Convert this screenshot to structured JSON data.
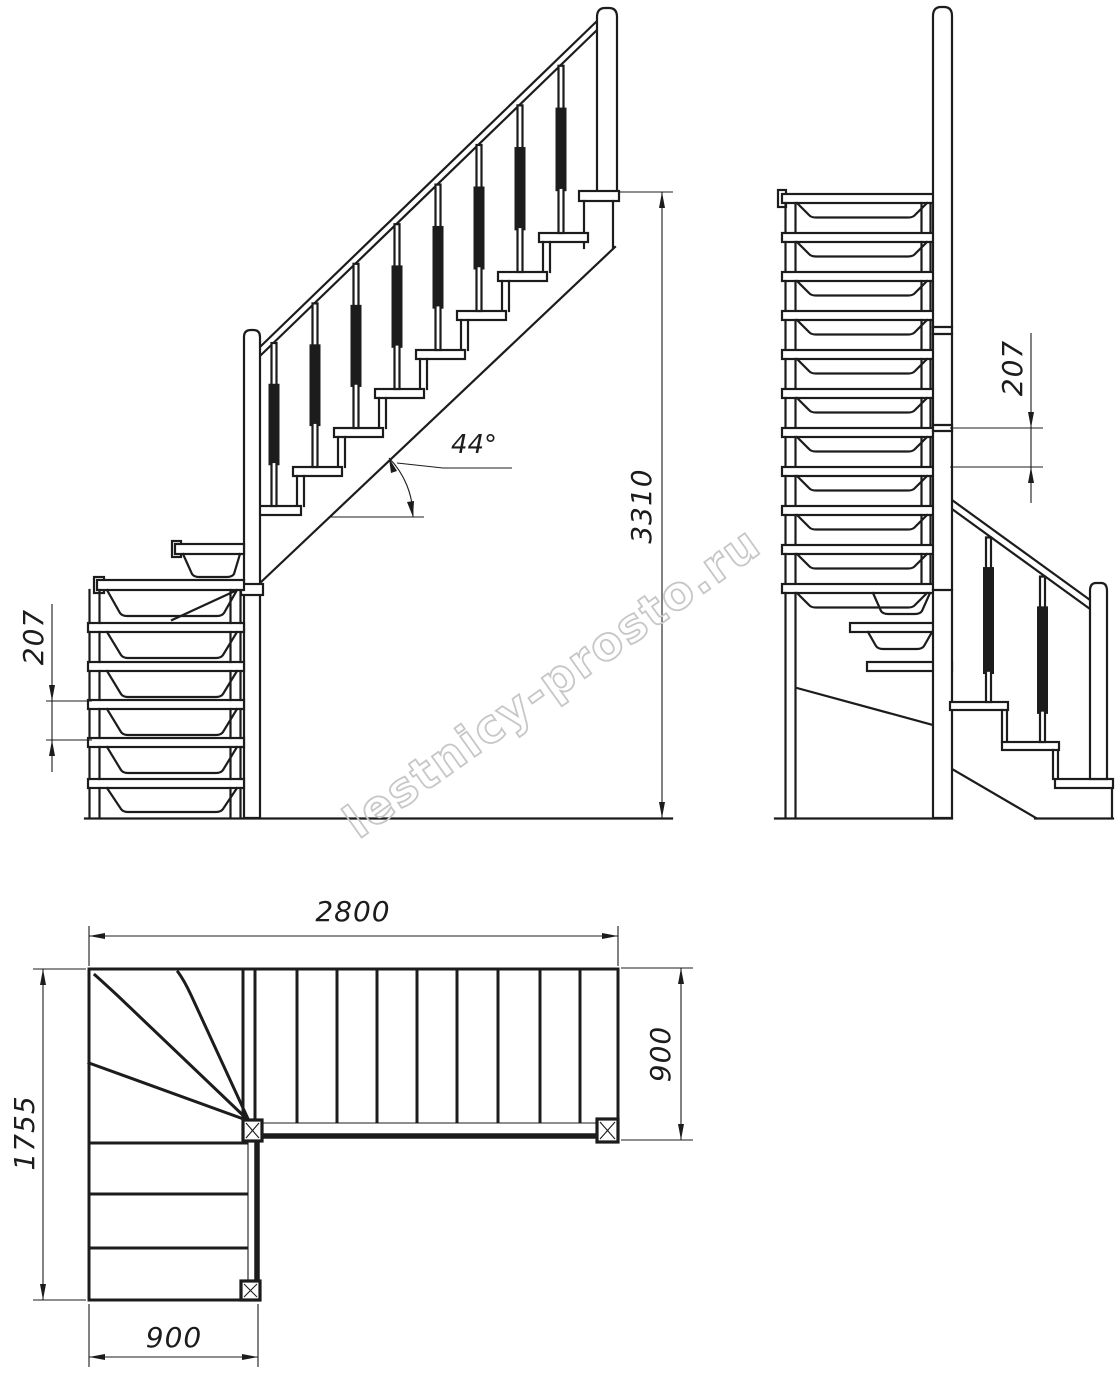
{
  "title": "L-shaped winder staircase technical drawing",
  "watermark": {
    "text": "lestnicy-prosto.ru",
    "color": "#c7c7c7"
  },
  "colors": {
    "line": "#1c1c1c",
    "background": "#ffffff"
  },
  "dims": {
    "front": {
      "angle": "44°",
      "total_height": "3310",
      "riser": "207"
    },
    "side": {
      "riser": "207"
    },
    "plan": {
      "length": "2800",
      "width": "900",
      "depth": "1755",
      "lower_width": "900"
    }
  }
}
